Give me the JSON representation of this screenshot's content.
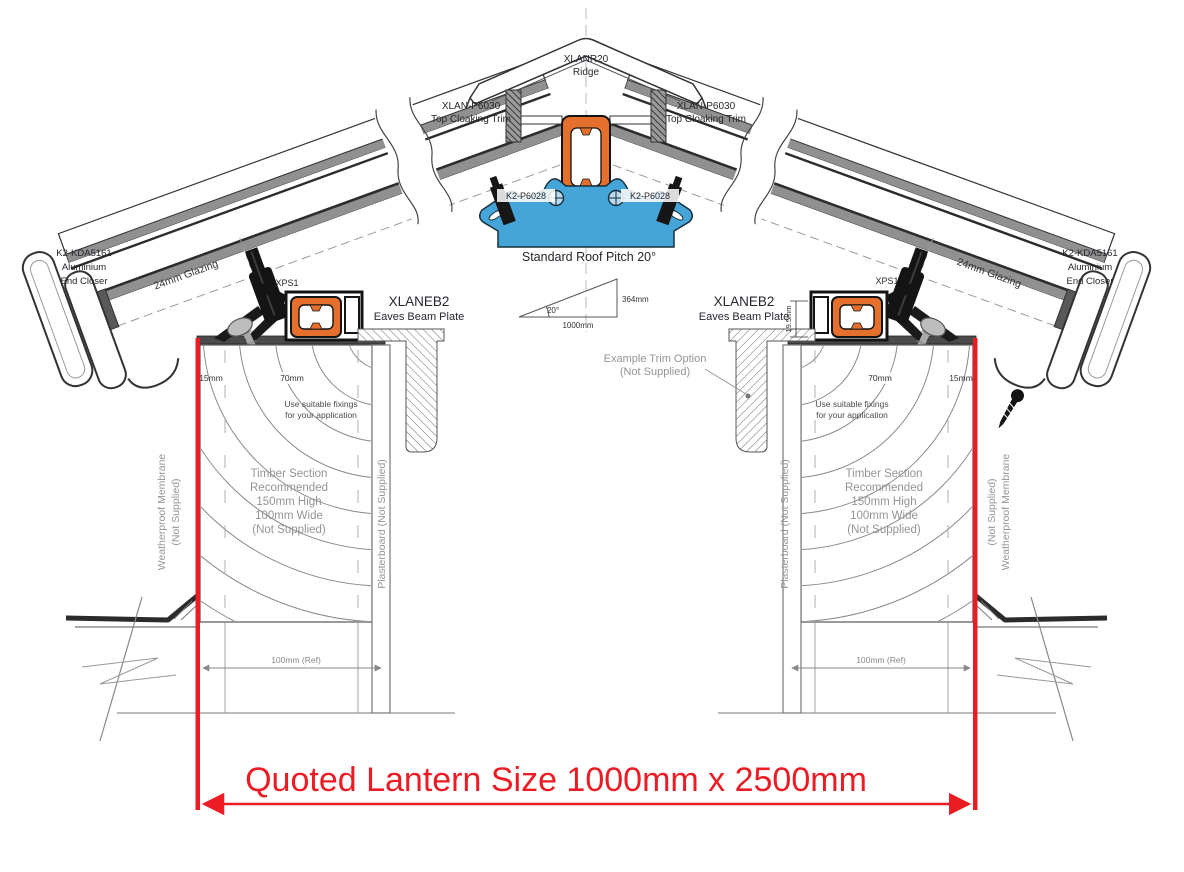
{
  "diagram": {
    "ridge": {
      "code": "XLANR20",
      "name": "Ridge"
    },
    "cloaking_trim": {
      "code": "XLAN-P6030",
      "name": "Top Cloaking Trim"
    },
    "glazing_bar_clip": {
      "code": "K2-P6028"
    },
    "pitch": {
      "note": "Standard Roof Pitch 20°",
      "angle": "20°",
      "base": "1000mm",
      "rise": "364mm"
    },
    "end_closer": {
      "code": "K2-KDA5161",
      "line2": "Aluminium",
      "line3": "End Closer"
    },
    "glazing": {
      "label": "24mm Glazing"
    },
    "xps": {
      "label": "XPS1"
    },
    "eaves_beam": {
      "code": "XLANEB2",
      "name": "Eaves Beam Plate"
    },
    "dims": {
      "d15": "15mm",
      "d70": "70mm",
      "d19_5": "19.5mm",
      "ref100": "100mm (Ref)"
    },
    "fixings": {
      "line1": "Use suitable fixings",
      "line2": "for your application"
    },
    "timber": {
      "line1": "Timber Section",
      "line2": "Recommended",
      "line3": "150mm High",
      "line4": "100mm Wide",
      "line5": "(Not Supplied)"
    },
    "membrane": {
      "line1": "Weatherproof Membrane",
      "line2": "(Not Supplied)"
    },
    "plasterboard": {
      "label": "Plasterboard (Not Supplied)"
    },
    "trim_option": {
      "line1": "Example Trim Option",
      "line2": "(Not Supplied)"
    },
    "quote": {
      "label": "Quoted Lantern Size 1000mm x 2500mm"
    },
    "colors": {
      "red": "#EC1C24",
      "orange": "#E56F2C",
      "blue": "#45A4D8",
      "gray_text": "#949494"
    }
  }
}
